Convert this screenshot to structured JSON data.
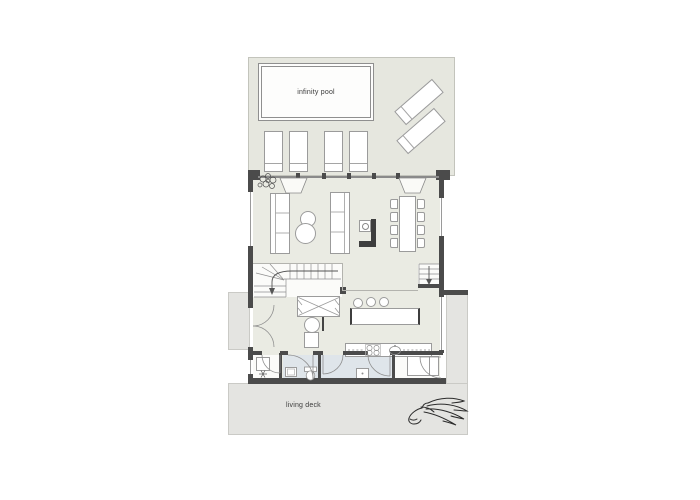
{
  "labels": {
    "pool": "infinity pool",
    "deck": "living deck"
  },
  "colors": {
    "background": "#ffffff",
    "terrace_floor": "#e6e7df",
    "interior_floor": "#eaebe3",
    "deck_floor": "#e4e4e1",
    "bathroom_floor": "#dfe5ea",
    "wall": "#4b4b4b",
    "line": "#8f8f8f",
    "text": "#3a3a3a"
  },
  "icons": {
    "logo": "horse-logo",
    "plant": "plant-icon"
  }
}
